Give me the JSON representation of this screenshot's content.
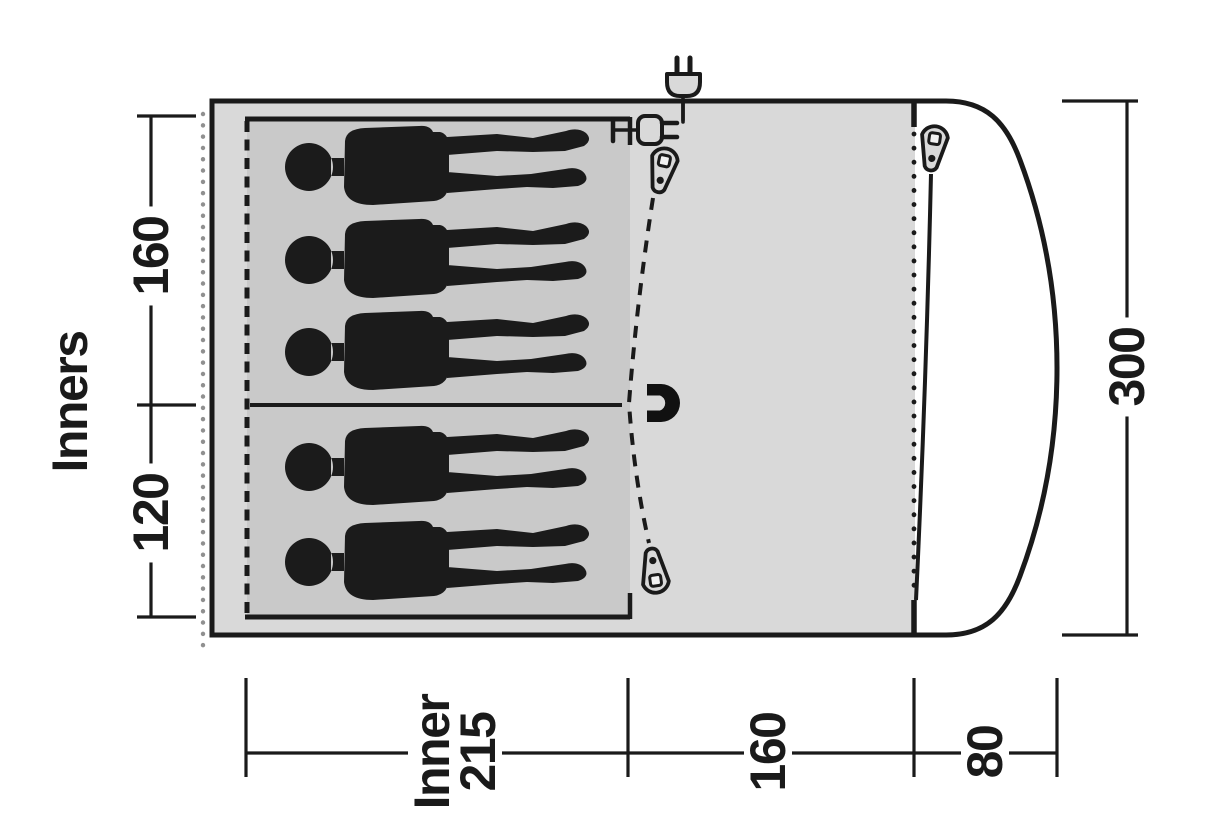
{
  "diagram": {
    "title": "Tent floor plan",
    "type": "tent-floorplan",
    "labels": {
      "inners": "Inners",
      "inner_height_top": "160",
      "inner_height_bottom": "120",
      "tent_depth": "300",
      "inner_width_line1": "Inner",
      "inner_width_line2": "215",
      "living_width": "160",
      "canopy_width": "80"
    },
    "figures": {
      "person_count": 5,
      "top_bedroom_persons": 3,
      "bottom_bedroom_persons": 2
    },
    "icons": [
      "power-plug-icon",
      "cable-entry-plug-icon",
      "zipper-pull-icon",
      "magnet-icon",
      "person-silhouette"
    ],
    "colors": {
      "line": "#1a1a1a",
      "living_area": "#d9d9d9",
      "inner_bedroom": "#c9c9c9",
      "porch": "#ffffff",
      "groundsheet_dots": "#909090"
    }
  }
}
